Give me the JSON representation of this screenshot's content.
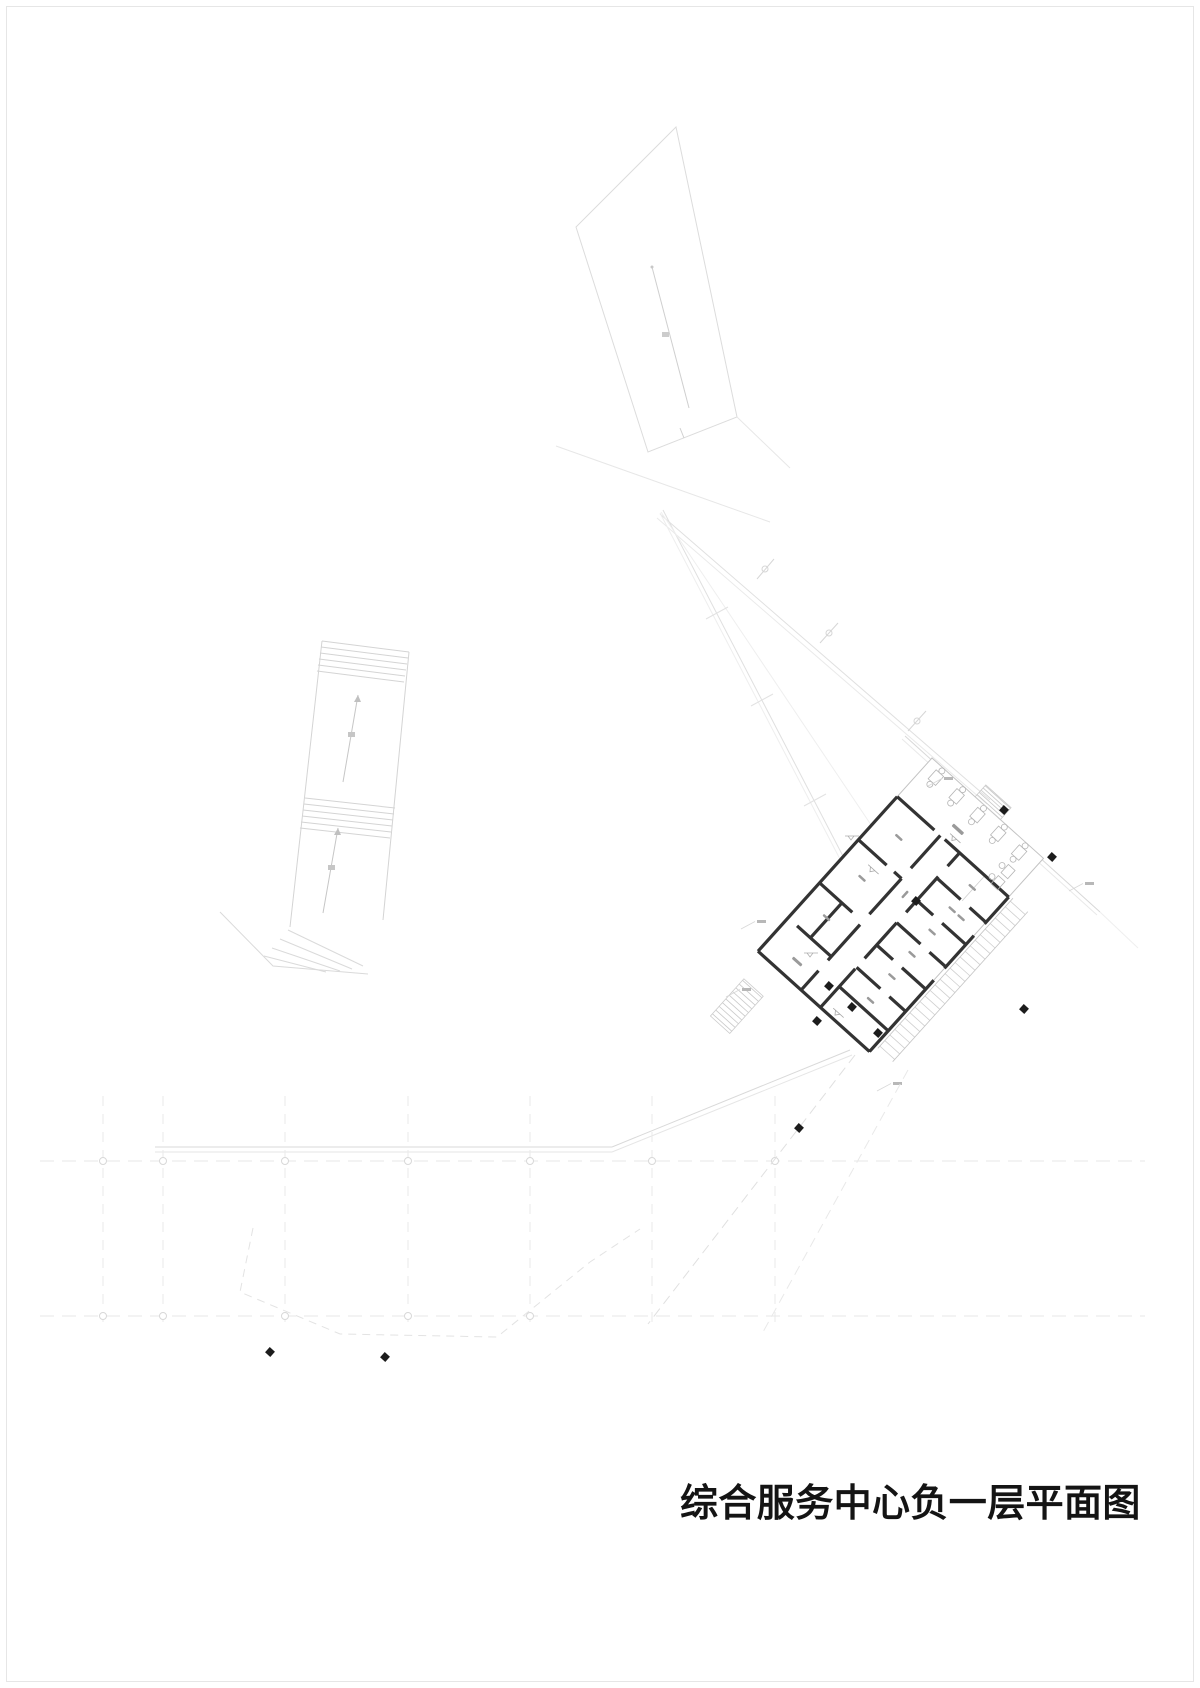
{
  "drawing": {
    "title": "综合服务中心负一层平面图",
    "type_note": "basement-floor-plan"
  },
  "colors": {
    "wall_dark": "#333333",
    "outline_medium": "#c3c3c3",
    "line_light": "#d4d4d4",
    "line_faint": "#e4e4e4",
    "column_fill": "#1c1c1c",
    "label_mark": "#9a9a9a",
    "furniture": "#b5b5b5",
    "grid_dash": "#e7e7e7",
    "node_stroke": "#d8d8d8"
  },
  "site": {
    "axis_y_top": 1161,
    "axis_y_bottom": 1316,
    "axis_node_xs_top": [
      103,
      163,
      285,
      408,
      530,
      652,
      775
    ],
    "axis_node_xs_bottom": [
      103,
      163,
      285,
      408,
      530
    ],
    "vgrid_xs": [
      103,
      163,
      285,
      408,
      530,
      652,
      775
    ],
    "vgrid_y1": 1096,
    "vgrid_y2": 1326,
    "columns": [
      [
        1004,
        810
      ],
      [
        1052,
        857
      ],
      [
        916,
        901
      ],
      [
        829,
        986
      ],
      [
        817,
        1021
      ],
      [
        852,
        1007
      ],
      [
        878,
        1033
      ],
      [
        1024,
        1009
      ],
      [
        799,
        1128
      ],
      [
        270,
        1352
      ],
      [
        385,
        1357
      ]
    ],
    "column_rotation_deg": 42
  },
  "building": {
    "rotation_deg": 42,
    "origin": [
      932,
      758
    ],
    "width": 150,
    "length": 260,
    "furniture_xs": [
      16,
      44,
      72,
      100,
      128
    ],
    "room_marks": [
      [
        112,
        68,
        9,
        2.5
      ],
      [
        112,
        98,
        9,
        2.5
      ],
      [
        112,
        128,
        9,
        2.5
      ],
      [
        112,
        158,
        9,
        2.5
      ],
      [
        112,
        188,
        9,
        2.5
      ],
      [
        112,
        220,
        9,
        2.5
      ],
      [
        24,
        80,
        9,
        2.5
      ],
      [
        24,
        135,
        9,
        2.5
      ],
      [
        24,
        188,
        9,
        2.5
      ],
      [
        30,
        240,
        12,
        3
      ],
      [
        60,
        34,
        14,
        3.5
      ],
      [
        70,
        115,
        2.5,
        9
      ],
      [
        124,
        98,
        9,
        2.5
      ]
    ],
    "ne_steps": {
      "x1": 58,
      "x2": 92,
      "y0": -15,
      "step": 3,
      "count": 6
    },
    "se_ramp": {
      "x1": 154,
      "x2": 174,
      "y0": 54,
      "step": 7.5,
      "count": 27
    },
    "w_stairs": {
      "x1": 8,
      "x2": 34,
      "y0": 292,
      "step": 5,
      "count": 10
    }
  },
  "annotations": {
    "slope_arrow_count": 3,
    "leader_marks": [
      [
        757,
        920
      ],
      [
        742,
        988
      ],
      [
        893,
        1082
      ],
      [
        944,
        777
      ],
      [
        1085,
        882
      ]
    ]
  }
}
